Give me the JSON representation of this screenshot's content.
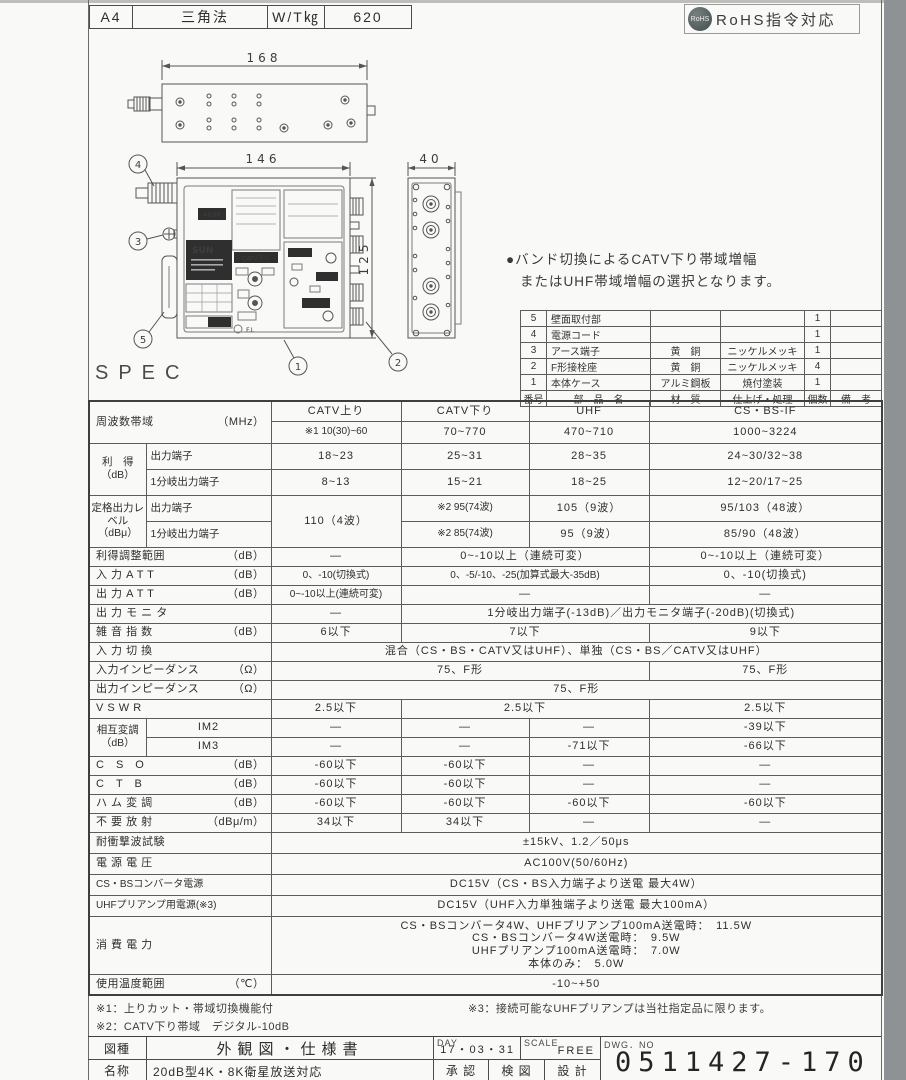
{
  "meta": {
    "paper_size": "A4",
    "projection": "三角法",
    "weight_label": "W/T㎏",
    "weight_value": "620",
    "rohs_badge": "RoHS",
    "rohs_text": "RoHS指令対応"
  },
  "note": {
    "line1": "●バンド切換によるCATV下り帯域増幅",
    "line2": "またはUHF帯域増幅の選択となります。"
  },
  "drawing": {
    "dims": {
      "overall_width": "168",
      "front_width": "146",
      "front_height": "125",
      "side_width": "40"
    },
    "callouts": {
      "c1": "1",
      "c2": "2",
      "c3": "3",
      "c4": "4",
      "c5": "5"
    },
    "panel": {
      "brand": "SUN",
      "badge_4k8k": "4K8K",
      "badge_catv": "CATV下り",
      "label_fl": "F.L"
    }
  },
  "parts": {
    "headers": [
      "番号",
      "部　品　名",
      "材　質",
      "仕上げ・処理",
      "個数",
      "備　考"
    ],
    "rows": [
      {
        "no": "5",
        "name": "壁面取付部",
        "material": "",
        "finish": "",
        "qty": "1",
        "note": ""
      },
      {
        "no": "4",
        "name": "電源コード",
        "material": "",
        "finish": "",
        "qty": "1",
        "note": ""
      },
      {
        "no": "3",
        "name": "アース端子",
        "material": "黄　銅",
        "finish": "ニッケルメッキ",
        "qty": "1",
        "note": ""
      },
      {
        "no": "2",
        "name": "F形接栓座",
        "material": "黄　銅",
        "finish": "ニッケルメッキ",
        "qty": "4",
        "note": ""
      },
      {
        "no": "1",
        "name": "本体ケース",
        "material": "アルミ鋼板",
        "finish": "焼付塗装",
        "qty": "1",
        "note": ""
      }
    ]
  },
  "spec": {
    "heading": "SPEC",
    "freq": {
      "label": "周波数帯域",
      "unit": "（MHz）",
      "bands": [
        "CATV上り",
        "CATV下り",
        "UHF",
        "CS・BS-IF"
      ],
      "values": [
        "※1 10(30)~60",
        "70~770",
        "470~710",
        "1000~3224"
      ]
    },
    "gain": {
      "label": "利　得",
      "unit": "（dB）",
      "sub1": "出力端子",
      "sub2": "1分岐出力端子",
      "r1": [
        "18~23",
        "25~31",
        "28~35",
        "24~30/32~38"
      ],
      "r2": [
        "8~13",
        "15~21",
        "18~25",
        "12~20/17~25"
      ]
    },
    "rated": {
      "label": "定格出力レベル",
      "unit": "（dBμ）",
      "sub1": "出力端子",
      "sub2": "1分岐出力端子",
      "catv_up": "110（4波）",
      "r1": [
        "※2 95(74波)",
        "105（9波）",
        "95/103（48波）"
      ],
      "r2": [
        "※2 85(74波)",
        "95（9波）",
        "85/90（48波）"
      ]
    },
    "gain_adjust": {
      "label": "利得調整範囲",
      "unit": "（dB）",
      "c1": "—",
      "c23": "0~-10以上（連続可変）",
      "c4": "0~-10以上（連続可変）"
    },
    "input_att": {
      "label": "入 力 A T T",
      "unit": "（dB）",
      "c1": "0、-10(切換式)",
      "c23": "0、-5/-10、-25(加算式最大-35dB)",
      "c4": "0、-10(切換式)"
    },
    "output_att": {
      "label": "出 力 A T T",
      "unit": "（dB）",
      "c1": "0~-10以上(連続可変)",
      "c23": "—",
      "c4": "—"
    },
    "output_monitor": {
      "label": "出 力 モ ニ タ",
      "c1": "—",
      "c234": "1分岐出力端子(-13dB)／出力モニタ端子(-20dB)(切換式)"
    },
    "noise": {
      "label": "雑 音 指 数",
      "unit": "（dB）",
      "c1": "6以下",
      "c23": "7以下",
      "c4": "9以下"
    },
    "input_select": {
      "label": "入 力 切 換",
      "c1234": "混合（CS・BS・CATV又はUHF）、単独（CS・BS／CATV又はUHF）"
    },
    "input_imp": {
      "label": "入力インピーダンス",
      "unit": "（Ω）",
      "c123": "75、F形",
      "c4": "75、F形"
    },
    "output_imp": {
      "label": "出力インピーダンス",
      "unit": "（Ω）",
      "c1234": "75、F形"
    },
    "vswr": {
      "label": "V S W R",
      "c1": "2.5以下",
      "c23": "2.5以下",
      "c4": "2.5以下"
    },
    "im": {
      "label": "相互変調（dB）",
      "sub1": "IM2",
      "sub2": "IM3",
      "r1": [
        "—",
        "—",
        "—",
        "-39以下"
      ],
      "r2": [
        "—",
        "—",
        "-71以下",
        "-66以下"
      ]
    },
    "cso": {
      "label": "C　S　O",
      "unit": "（dB）",
      "cells": [
        "-60以下",
        "-60以下",
        "—",
        "—"
      ]
    },
    "ctb": {
      "label": "C　T　B",
      "unit": "（dB）",
      "cells": [
        "-60以下",
        "-60以下",
        "—",
        "—"
      ]
    },
    "hum": {
      "label": "ハ ム 変 調",
      "unit": "（dB）",
      "cells": [
        "-60以下",
        "-60以下",
        "-60以下",
        "-60以下"
      ]
    },
    "spurious": {
      "label": "不 要 放 射",
      "unit": "（dBμ/m）",
      "cells": [
        "34以下",
        "34以下",
        "—",
        "—"
      ]
    },
    "surge": {
      "label": "耐衝撃波試験",
      "value": "±15kV、1.2／50μs"
    },
    "voltage": {
      "label": "電 源 電 圧",
      "value": "AC100V(50/60Hz)"
    },
    "csbs_power": {
      "label": "CS・BSコンバータ電源",
      "value": "DC15V（CS・BS入力端子より送電 最大4W）"
    },
    "uhf_power": {
      "label": "UHFプリアンプ用電源(※3)",
      "value": "DC15V（UHF入力単独端子より送電 最大100mA）"
    },
    "consumption": {
      "label": "消 費 電 力",
      "lines": [
        "CS・BSコンバータ4W、UHFプリアンプ100mA送電時：　11.5W",
        "CS・BSコンバータ4W送電時：　9.5W",
        "UHFプリアンプ100mA送電時：　7.0W",
        "本体のみ：　5.0W"
      ]
    },
    "temp": {
      "label": "使用温度範囲",
      "unit": "（℃）",
      "value": "-10~+50"
    }
  },
  "footnotes": {
    "f1": "※1：上りカット・帯域切換機能付",
    "f2": "※2：CATV下り帯域　デジタル-10dB",
    "f3": "※3：接続可能なUHFプリアンプは当社指定品に限ります。"
  },
  "title_block": {
    "type_label": "図種",
    "type_value": "外観図・仕様書",
    "day_label": "DAY",
    "day_value": "17・03・31",
    "scale_label": "SCALE",
    "scale_value": "FREE",
    "dwg_label": "DWG．NO",
    "dwg_value": "0511427-170",
    "name_label": "名称",
    "name_value": "20dB型4K・8K衛星放送対応",
    "approve": "承 認",
    "check": "検 図",
    "design": "設 計"
  },
  "colors": {
    "line": "#4c4c4c",
    "text": "#2e2e2e",
    "page_bg": "#f9f9f7",
    "photo_edge": "#8f9294",
    "badge_bg": "#4a5458"
  }
}
